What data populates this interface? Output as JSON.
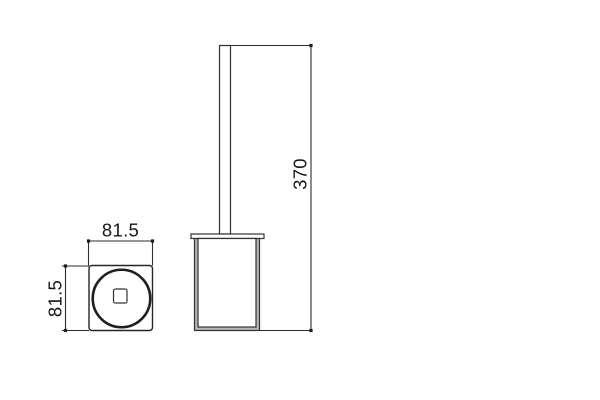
{
  "page": {
    "background_color": "#ffffff",
    "line_color": "#2d2d2d",
    "text_color": "#141414"
  },
  "drawing": {
    "kind": "technical-dimension-drawing",
    "views": {
      "top": {
        "label": "top-view",
        "dimensions": [
          {
            "axis": "horizontal",
            "value": "81.5"
          },
          {
            "axis": "vertical",
            "value": "81.5"
          }
        ]
      },
      "side": {
        "label": "side-view",
        "dimensions": [
          {
            "axis": "vertical",
            "value": "370"
          }
        ]
      }
    }
  }
}
